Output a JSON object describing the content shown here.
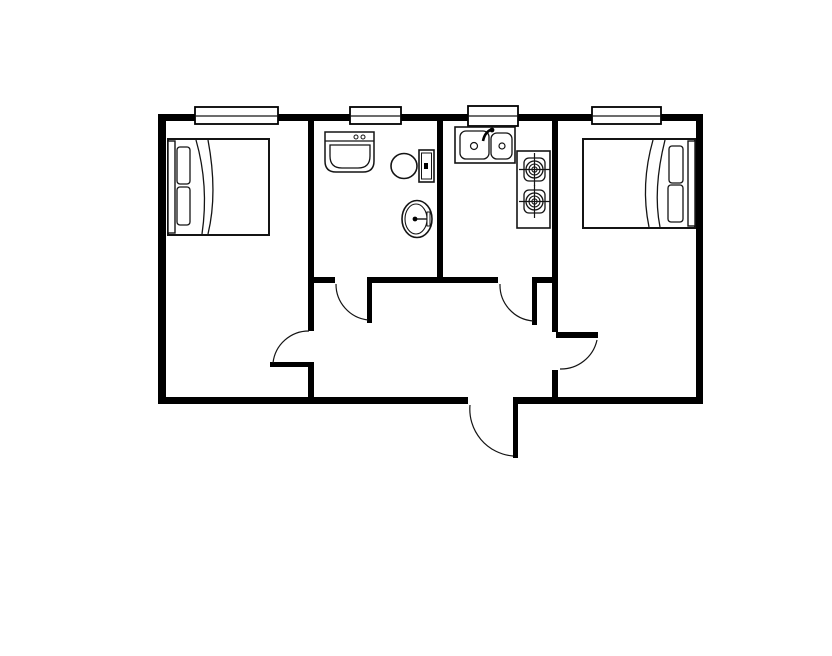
{
  "canvas": {
    "width": 832,
    "height": 656,
    "background": "#ffffff"
  },
  "floorplan": {
    "description_name": "two-bedroom-apartment-floor-plan",
    "colors": {
      "wall": "#000000",
      "line": "#141414",
      "fill": "#ffffff"
    },
    "defaults": {
      "fill": "none",
      "stroke": "#141414",
      "sw": 1.4
    },
    "shapes": [
      {
        "name": "wall-top",
        "type": "rect",
        "x": 158,
        "y": 114,
        "w": 545,
        "h": 7,
        "fill": "#000000",
        "stroke": "none"
      },
      {
        "name": "wall-left",
        "type": "rect",
        "x": 158,
        "y": 114,
        "w": 8,
        "h": 290,
        "fill": "#000000",
        "stroke": "none"
      },
      {
        "name": "wall-right",
        "type": "rect",
        "x": 696,
        "y": 114,
        "w": 7,
        "h": 290,
        "fill": "#000000",
        "stroke": "none"
      },
      {
        "name": "wall-bottom-west",
        "type": "rect",
        "x": 158,
        "y": 397,
        "w": 310,
        "h": 7,
        "fill": "#000000",
        "stroke": "none"
      },
      {
        "name": "wall-bottom-east",
        "type": "rect",
        "x": 513,
        "y": 397,
        "w": 190,
        "h": 7,
        "fill": "#000000",
        "stroke": "none"
      },
      {
        "name": "wall-bedroom-left-east-upper",
        "type": "rect",
        "x": 308,
        "y": 121,
        "w": 6,
        "h": 210,
        "fill": "#000000",
        "stroke": "none"
      },
      {
        "name": "wall-bedroom-left-east-lower",
        "type": "rect",
        "x": 308,
        "y": 363,
        "w": 6,
        "h": 34,
        "fill": "#000000",
        "stroke": "none"
      },
      {
        "name": "wall-bathroom-kitchen-partition",
        "type": "rect",
        "x": 437,
        "y": 121,
        "w": 6,
        "h": 162,
        "fill": "#000000",
        "stroke": "none"
      },
      {
        "name": "wall-kitchen-bedroom-right-upper",
        "type": "rect",
        "x": 552,
        "y": 121,
        "w": 6,
        "h": 211,
        "fill": "#000000",
        "stroke": "none"
      },
      {
        "name": "wall-kitchen-bedroom-right-lower",
        "type": "rect",
        "x": 552,
        "y": 370,
        "w": 6,
        "h": 27,
        "fill": "#000000",
        "stroke": "none"
      },
      {
        "name": "wall-hall-north-west",
        "type": "rect",
        "x": 308,
        "y": 277,
        "w": 27,
        "h": 6,
        "fill": "#000000",
        "stroke": "none"
      },
      {
        "name": "wall-hall-north-mid",
        "type": "rect",
        "x": 367,
        "y": 277,
        "w": 131,
        "h": 6,
        "fill": "#000000",
        "stroke": "none"
      },
      {
        "name": "wall-hall-north-east",
        "type": "rect",
        "x": 532,
        "y": 277,
        "w": 26,
        "h": 6,
        "fill": "#000000",
        "stroke": "none"
      },
      {
        "name": "window-bedroom-left",
        "type": "rect",
        "x": 195,
        "y": 107,
        "w": 83,
        "h": 17,
        "fill": "#ffffff",
        "stroke": "#000000",
        "sw": 1.8
      },
      {
        "name": "window-bedroom-left-mullion",
        "type": "line",
        "x1": 195,
        "y1": 116,
        "x2": 278,
        "y2": 116,
        "sw": 1.2
      },
      {
        "name": "window-bathroom",
        "type": "rect",
        "x": 350,
        "y": 107,
        "w": 51,
        "h": 17,
        "fill": "#ffffff",
        "stroke": "#000000",
        "sw": 1.8
      },
      {
        "name": "window-bathroom-mullion",
        "type": "line",
        "x1": 350,
        "y1": 116,
        "x2": 401,
        "y2": 116,
        "sw": 1.2
      },
      {
        "name": "window-kitchen",
        "type": "rect",
        "x": 468,
        "y": 106,
        "w": 50,
        "h": 20,
        "fill": "#ffffff",
        "stroke": "#000000",
        "sw": 1.8
      },
      {
        "name": "window-kitchen-mullion",
        "type": "line",
        "x1": 468,
        "y1": 116,
        "x2": 518,
        "y2": 116,
        "sw": 1.2
      },
      {
        "name": "window-bedroom-right",
        "type": "rect",
        "x": 592,
        "y": 107,
        "w": 69,
        "h": 17,
        "fill": "#ffffff",
        "stroke": "#000000",
        "sw": 1.8
      },
      {
        "name": "window-bedroom-right-mullion",
        "type": "line",
        "x1": 592,
        "y1": 116,
        "x2": 661,
        "y2": 116,
        "sw": 1.2
      },
      {
        "name": "door-leaf-bathroom",
        "type": "rect",
        "x": 367,
        "y": 277,
        "w": 5,
        "h": 46,
        "fill": "#000000",
        "stroke": "none"
      },
      {
        "name": "door-arc-bathroom",
        "type": "path",
        "d": "M336,284 A36,36 0 0 0 368,320",
        "sw": 1.2
      },
      {
        "name": "door-leaf-kitchen",
        "type": "rect",
        "x": 532,
        "y": 277,
        "w": 5,
        "h": 48,
        "fill": "#000000",
        "stroke": "none"
      },
      {
        "name": "door-arc-kitchen",
        "type": "path",
        "d": "M500,284 A36,36 0 0 0 533,321",
        "sw": 1.2
      },
      {
        "name": "door-leaf-bedroom-left",
        "type": "rect",
        "x": 270,
        "y": 362,
        "w": 44,
        "h": 5,
        "fill": "#000000",
        "stroke": "none"
      },
      {
        "name": "door-arc-bedroom-left",
        "type": "path",
        "d": "M309,331 A36,36 0 0 0 273,363",
        "sw": 1.2
      },
      {
        "name": "door-leaf-bedroom-right",
        "type": "rect",
        "x": 556,
        "y": 332,
        "w": 42,
        "h": 6,
        "fill": "#000000",
        "stroke": "none"
      },
      {
        "name": "door-arc-bedroom-right",
        "type": "path",
        "d": "M597,340 A37,37 0 0 1 560,369",
        "sw": 1.2
      },
      {
        "name": "door-leaf-entry",
        "type": "rect",
        "x": 513,
        "y": 404,
        "w": 5,
        "h": 54,
        "fill": "#000000",
        "stroke": "none"
      },
      {
        "name": "door-arc-entry",
        "type": "path",
        "d": "M470,405 A47,47 0 0 0 513,456",
        "sw": 1.2
      },
      {
        "name": "bed-left-frame",
        "type": "rect",
        "x": 168,
        "y": 139,
        "w": 101,
        "h": 96,
        "fill": "#ffffff",
        "sw": 2
      },
      {
        "name": "bed-left-headboard",
        "type": "rect",
        "x": 168,
        "y": 141,
        "w": 7,
        "h": 92,
        "fill": "#ffffff",
        "sw": 1.4
      },
      {
        "name": "bed-left-pillow-top",
        "type": "rect",
        "x": 177,
        "y": 147,
        "w": 13,
        "h": 37,
        "rx": 3,
        "sw": 1.3
      },
      {
        "name": "bed-left-pillow-bottom",
        "type": "rect",
        "x": 177,
        "y": 187,
        "w": 13,
        "h": 38,
        "rx": 3,
        "sw": 1.3
      },
      {
        "name": "bed-left-blanket-fold-outer",
        "type": "path",
        "d": "M196,140 C204,168 207,200 202,234",
        "sw": 1.3
      },
      {
        "name": "bed-left-blanket-fold-inner",
        "type": "path",
        "d": "M208,140 C214,172 215,205 208,234",
        "sw": 1.3
      },
      {
        "name": "bed-right-frame",
        "type": "rect",
        "x": 583,
        "y": 139,
        "w": 112,
        "h": 89,
        "fill": "#ffffff",
        "sw": 2
      },
      {
        "name": "bed-right-headboard",
        "type": "rect",
        "x": 688,
        "y": 141,
        "w": 7,
        "h": 85,
        "fill": "#ffffff",
        "sw": 1.4
      },
      {
        "name": "bed-right-pillow-top",
        "type": "rect",
        "x": 669,
        "y": 146,
        "w": 14,
        "h": 37,
        "rx": 3,
        "sw": 1.3
      },
      {
        "name": "bed-right-pillow-bottom",
        "type": "rect",
        "x": 668,
        "y": 185,
        "w": 15,
        "h": 37,
        "rx": 3,
        "sw": 1.3
      },
      {
        "name": "bed-right-blanket-fold-outer",
        "type": "path",
        "d": "M653,140 C645,168 643,198 649,227",
        "sw": 1.3
      },
      {
        "name": "bed-right-blanket-fold-inner",
        "type": "path",
        "d": "M665,140 C657,172 655,202 660,227",
        "sw": 1.3
      },
      {
        "name": "bathroom-vanity-body",
        "type": "path",
        "d": "M325,132 L374,132 L374,161 Q374,172 363,172 L336,172 Q325,172 325,161 Z",
        "fill": "#ffffff",
        "sw": 1.5
      },
      {
        "name": "bathroom-vanity-counter-line",
        "type": "line",
        "x1": 325,
        "y1": 141,
        "x2": 374,
        "y2": 141,
        "sw": 1.2
      },
      {
        "name": "bathroom-vanity-faucet-handle-left",
        "type": "circle",
        "cx": 356,
        "cy": 137,
        "r": 2,
        "fill": "#ffffff",
        "sw": 1
      },
      {
        "name": "bathroom-vanity-faucet-handle-right",
        "type": "circle",
        "cx": 363,
        "cy": 137,
        "r": 2,
        "fill": "#ffffff",
        "sw": 1
      },
      {
        "name": "bathroom-vanity-basin",
        "type": "path",
        "d": "M330,145 L370,145 L370,156 Q370,168 358,168 L342,168 Q330,168 330,156 Z",
        "sw": 1.3
      },
      {
        "name": "toilet-bowl",
        "type": "ellipse",
        "cx": 404,
        "cy": 166,
        "rx": 13,
        "ry": 12.5,
        "fill": "#ffffff",
        "sw": 1.6
      },
      {
        "name": "toilet-tank",
        "type": "rect",
        "x": 419,
        "y": 150,
        "w": 15,
        "h": 32,
        "fill": "#ffffff",
        "sw": 1.6
      },
      {
        "name": "toilet-tank-inner",
        "type": "rect",
        "x": 421.5,
        "y": 153,
        "w": 10,
        "h": 26,
        "sw": 1
      },
      {
        "name": "toilet-flush-button",
        "type": "rect",
        "x": 424,
        "y": 163,
        "w": 4,
        "h": 6,
        "fill": "#000000",
        "stroke": "none"
      },
      {
        "name": "bathroom-basin-oval-outer",
        "type": "ellipse",
        "cx": 417,
        "cy": 219,
        "rx": 15,
        "ry": 18.5,
        "fill": "#ffffff",
        "sw": 1.6
      },
      {
        "name": "bathroom-basin-oval-inner",
        "type": "ellipse",
        "cx": 416,
        "cy": 219,
        "rx": 11,
        "ry": 15,
        "sw": 1.1
      },
      {
        "name": "bathroom-basin-faucet-line",
        "type": "line",
        "x1": 416,
        "y1": 219,
        "x2": 430,
        "y2": 219,
        "sw": 1.4
      },
      {
        "name": "bathroom-basin-faucet-bar",
        "type": "rect",
        "x": 427,
        "y": 212,
        "w": 3,
        "h": 14,
        "fill": "#ffffff",
        "sw": 1
      },
      {
        "name": "bathroom-basin-drain-dot",
        "type": "circle",
        "cx": 415,
        "cy": 219,
        "r": 2.4,
        "fill": "#000000",
        "stroke": "none"
      },
      {
        "name": "kitchen-sink-counter",
        "type": "rect",
        "x": 455,
        "y": 127,
        "w": 60,
        "h": 36,
        "fill": "#ffffff",
        "sw": 1.6
      },
      {
        "name": "kitchen-sink-basin-left",
        "type": "rect",
        "x": 460,
        "y": 131,
        "w": 29,
        "h": 28,
        "rx": 6,
        "sw": 1.3
      },
      {
        "name": "kitchen-sink-basin-right",
        "type": "rect",
        "x": 491,
        "y": 133,
        "w": 21,
        "h": 26,
        "rx": 6,
        "sw": 1.3
      },
      {
        "name": "kitchen-sink-drain-left",
        "type": "circle",
        "cx": 474,
        "cy": 146,
        "r": 3.5,
        "fill": "#ffffff",
        "sw": 1.2
      },
      {
        "name": "kitchen-sink-drain-right",
        "type": "circle",
        "cx": 502,
        "cy": 146,
        "r": 3,
        "fill": "#ffffff",
        "sw": 1.2
      },
      {
        "name": "kitchen-sink-faucet-neck",
        "type": "path",
        "d": "M483,141 Q485,131 493,129",
        "sw": 2.6,
        "stroke": "#000000"
      },
      {
        "name": "kitchen-sink-faucet-head",
        "type": "circle",
        "cx": 492,
        "cy": 130,
        "r": 2.4,
        "fill": "#000000",
        "stroke": "none"
      },
      {
        "name": "stove-body",
        "type": "rect",
        "x": 517,
        "y": 151,
        "w": 33,
        "h": 77,
        "fill": "#ffffff",
        "sw": 1.6
      },
      {
        "name": "stove-burner-top-plate",
        "type": "rect",
        "x": 524,
        "y": 158,
        "w": 21,
        "h": 23,
        "rx": 5,
        "sw": 1.3
      },
      {
        "name": "stove-burner-top-ring-outer",
        "type": "circle",
        "cx": 534.5,
        "cy": 169.5,
        "r": 8.5,
        "sw": 1.3
      },
      {
        "name": "stove-burner-top-ring-mid",
        "type": "circle",
        "cx": 534.5,
        "cy": 169.5,
        "r": 5.5,
        "sw": 1.1
      },
      {
        "name": "stove-burner-top-ring-inner",
        "type": "circle",
        "cx": 534.5,
        "cy": 169.5,
        "r": 2.6,
        "sw": 1.1
      },
      {
        "name": "stove-burner-top-cross-h",
        "type": "line",
        "x1": 519,
        "y1": 169.5,
        "x2": 550,
        "y2": 169.5,
        "sw": 1.2
      },
      {
        "name": "stove-burner-top-cross-v",
        "type": "line",
        "x1": 534.5,
        "y1": 153,
        "x2": 534.5,
        "y2": 186,
        "sw": 1.2
      },
      {
        "name": "stove-burner-bottom-plate",
        "type": "rect",
        "x": 524,
        "y": 190,
        "w": 21,
        "h": 23,
        "rx": 5,
        "sw": 1.3
      },
      {
        "name": "stove-burner-bottom-ring-outer",
        "type": "circle",
        "cx": 534.5,
        "cy": 201.5,
        "r": 8.5,
        "sw": 1.3
      },
      {
        "name": "stove-burner-bottom-ring-mid",
        "type": "circle",
        "cx": 534.5,
        "cy": 201.5,
        "r": 5.5,
        "sw": 1.1
      },
      {
        "name": "stove-burner-bottom-ring-inner",
        "type": "circle",
        "cx": 534.5,
        "cy": 201.5,
        "r": 2.6,
        "sw": 1.1
      },
      {
        "name": "stove-burner-bottom-cross-h",
        "type": "line",
        "x1": 519,
        "y1": 201.5,
        "x2": 550,
        "y2": 201.5,
        "sw": 1.2
      },
      {
        "name": "stove-burner-bottom-cross-v",
        "type": "line",
        "x1": 534.5,
        "y1": 185,
        "x2": 534.5,
        "y2": 218,
        "sw": 1.2
      }
    ]
  }
}
